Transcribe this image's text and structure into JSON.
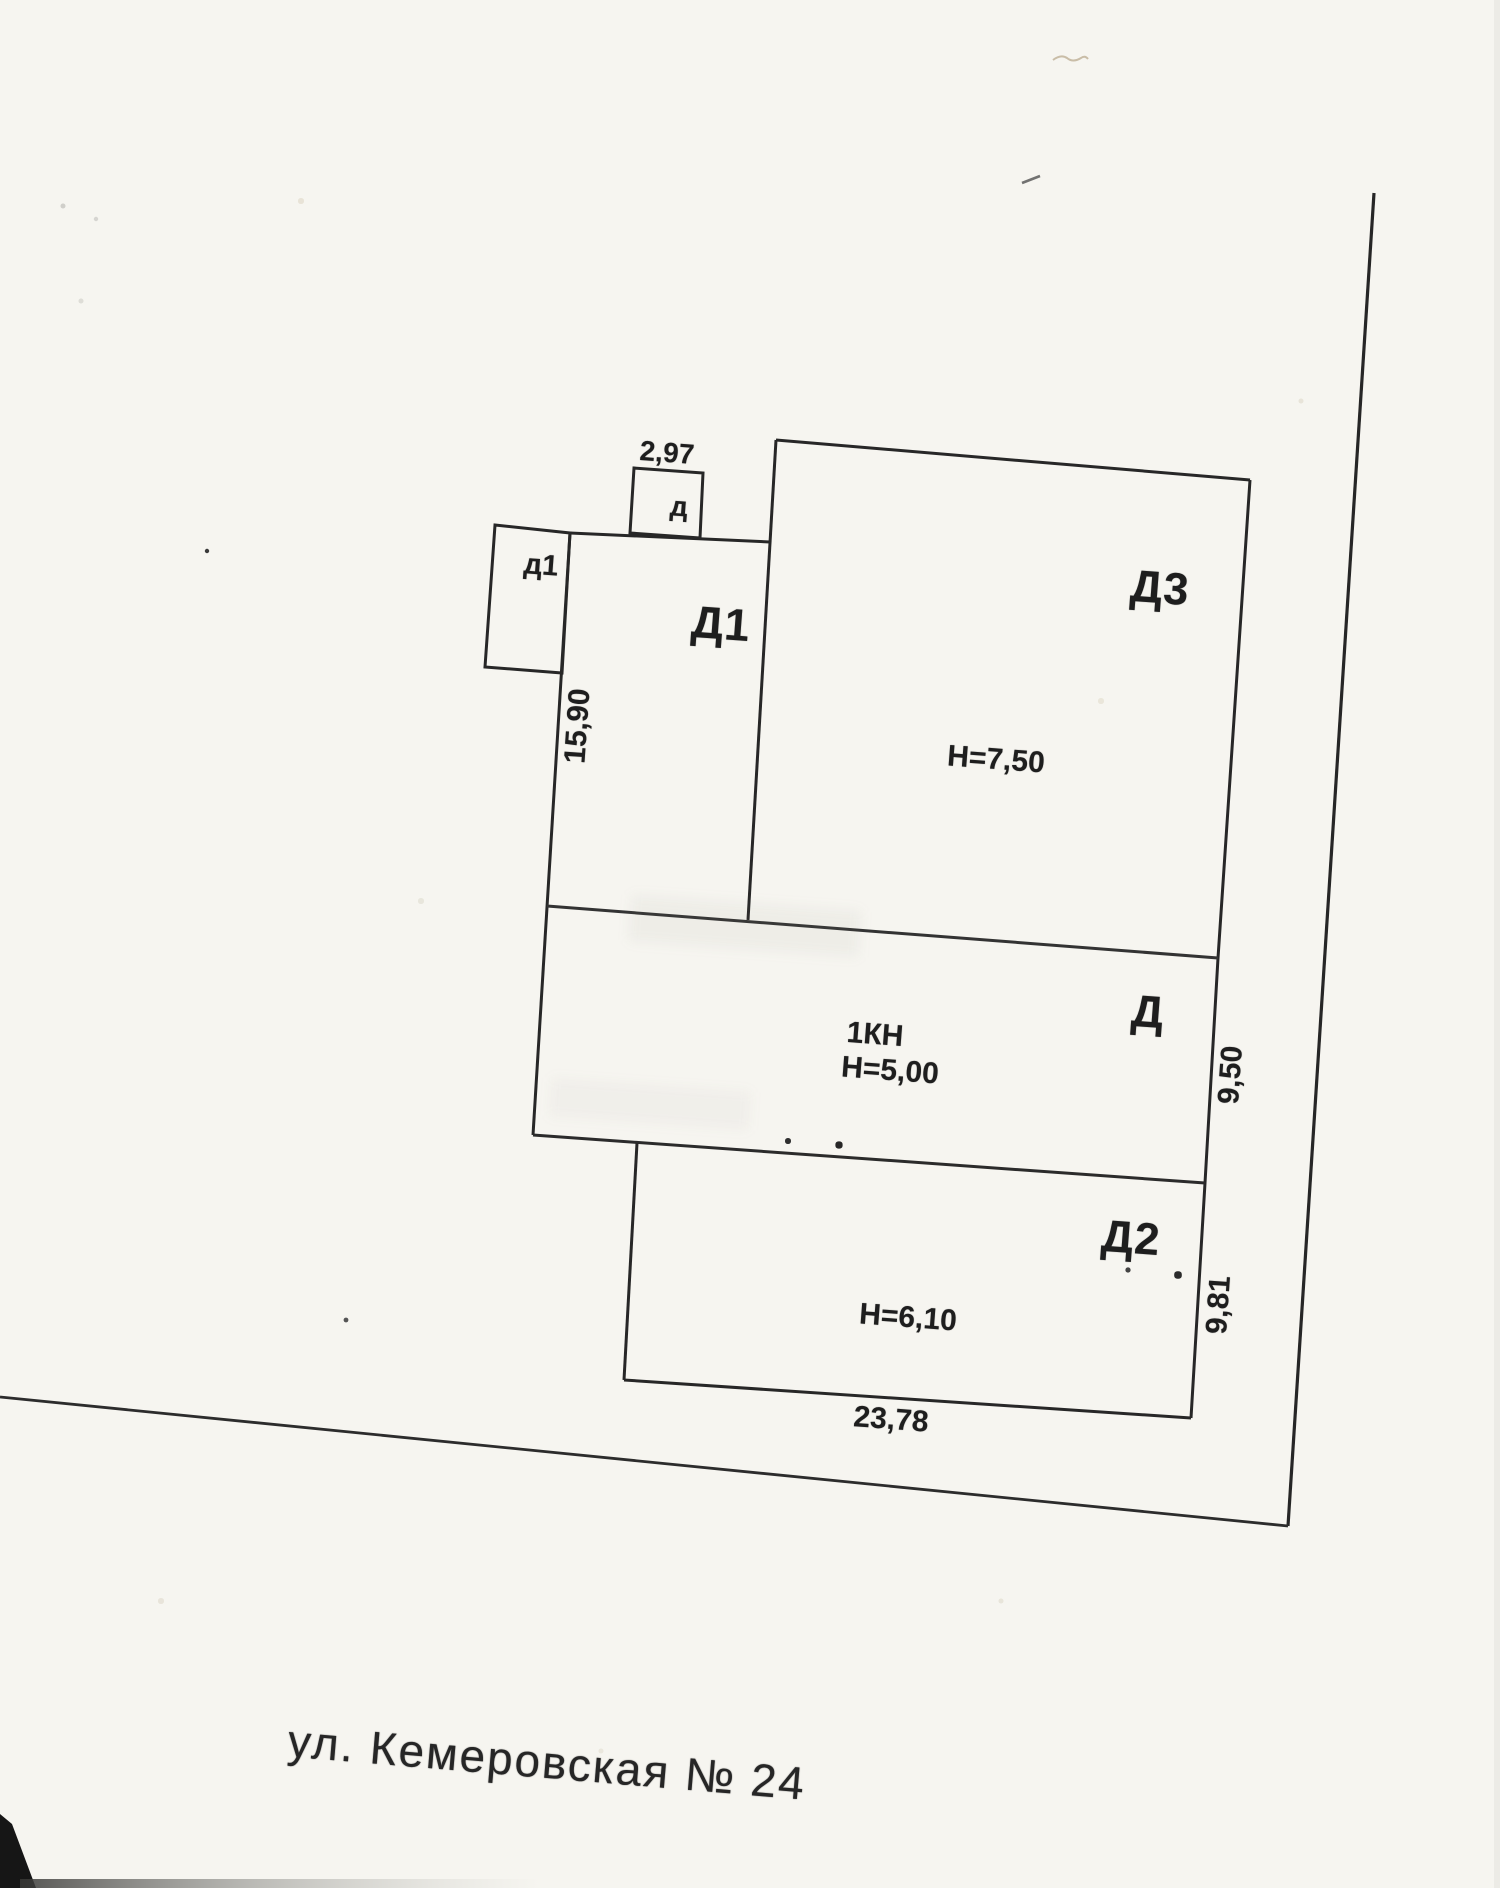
{
  "plan": {
    "address": "ул. Кемеровская № 24",
    "buildings": {
      "d1_main": {
        "label": "Д1"
      },
      "d3": {
        "label": "Д3",
        "height": "H=7,50"
      },
      "d_mid": {
        "label": "Д",
        "note": "1КН",
        "height": "H=5,00"
      },
      "d2": {
        "label": "Д2",
        "height": "H=6,10"
      },
      "annex_d": {
        "label": "д"
      },
      "annex_d1": {
        "label": "д1"
      }
    },
    "dimensions": {
      "top_width": "2,97",
      "left_length": "15,90",
      "right_mid": "9,50",
      "right_lower": "9,81",
      "bottom_width": "23,78"
    }
  }
}
